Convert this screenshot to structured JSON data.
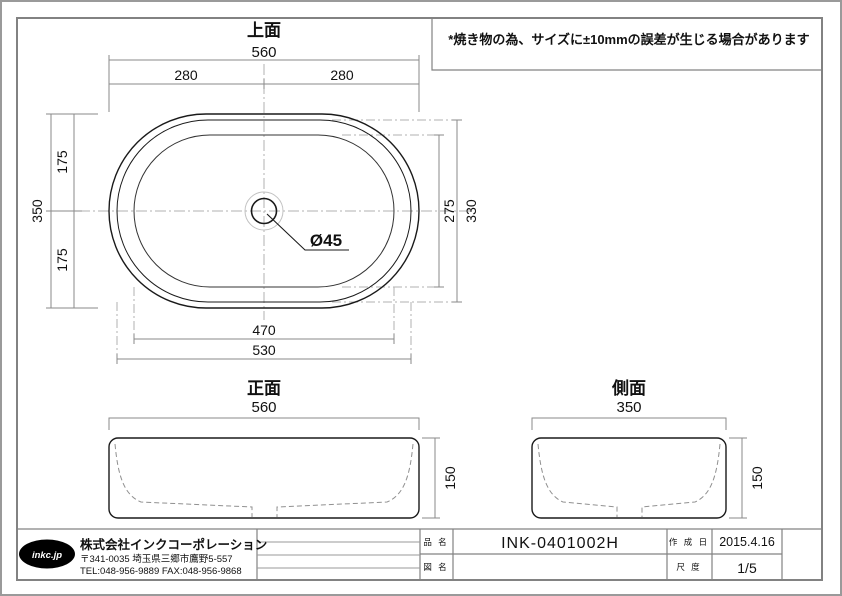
{
  "note": {
    "text": "*焼き物の為、サイズに±10mmの誤差が生じる場合があります"
  },
  "views": {
    "top": {
      "title": "上面",
      "dim_overall_width": "560",
      "dim_half_left": "280",
      "dim_half_right": "280",
      "dim_overall_depth": "350",
      "dim_half_top": "175",
      "dim_half_bottom": "175",
      "dim_inner_depth": "275",
      "dim_mid_depth": "330",
      "dim_inner_width": "470",
      "dim_mid_width": "530",
      "dim_drain": "Ø45"
    },
    "front": {
      "title": "正面",
      "dim_width": "560",
      "dim_height": "150"
    },
    "side": {
      "title": "側面",
      "dim_width": "350",
      "dim_height": "150"
    }
  },
  "title_block": {
    "logo_text": "inkc.jp",
    "company_name": "株式会社インクコーポレーション",
    "company_address": "〒341-0035 埼玉県三郷市鷹野5-557",
    "company_tel_fax": "TEL:048-956-9889 FAX:048-956-9868",
    "product_name_label": "品 名",
    "product_name_value": "INK-0401002H",
    "drawing_name_label": "図 名",
    "drawing_name_value": "",
    "created_date_label": "作 成 日",
    "created_date_value": "2015.4.16",
    "scale_label": "尺 度",
    "scale_value": "1/5"
  },
  "colors": {
    "line_strong": "#1a1a1a",
    "line_frame": "#828282",
    "line_dim": "#8a8a8a",
    "line_center": "#b2b2b2",
    "line_hidden": "#909090",
    "logo_bg": "#000000"
  }
}
